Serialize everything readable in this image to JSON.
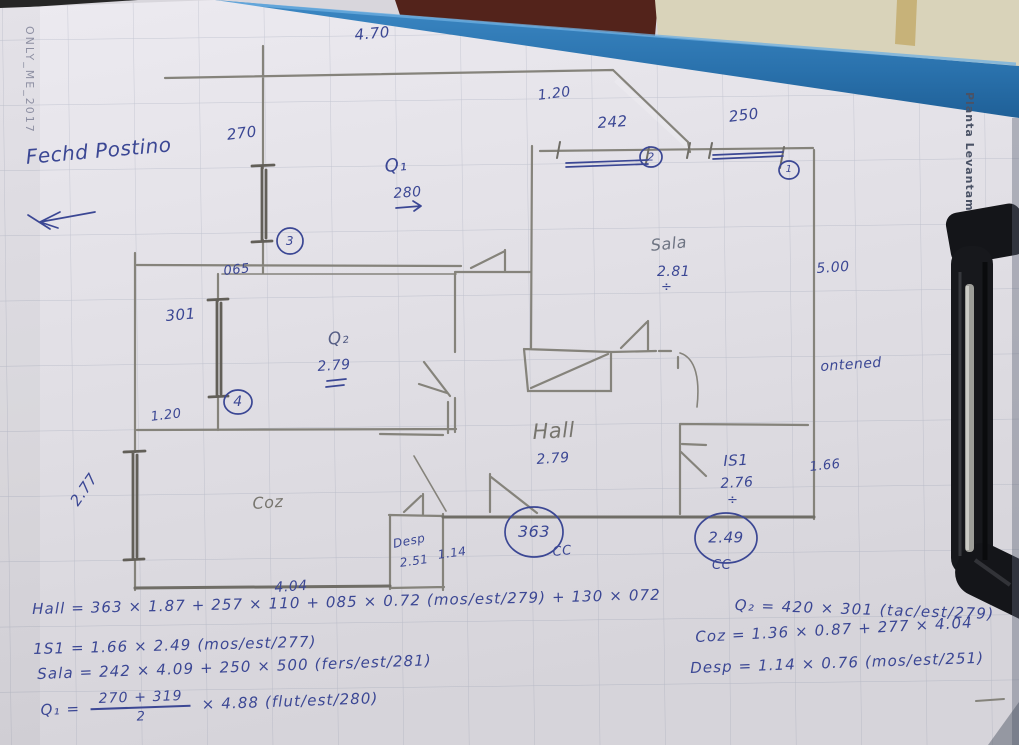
{
  "photo": {
    "margin_left_vertical_text": "ONLY_ME_2017",
    "margin_right_vertical_text": "Planta Levantamento"
  },
  "labels": {
    "note": "Fechd Postino",
    "d470": "4.70",
    "d270": "270",
    "ref1": "1",
    "ref2": "2",
    "ref3": "3",
    "ref4": "4",
    "d065": "065",
    "d301": "301",
    "d120_left": "1.20",
    "d277": "2.77",
    "coz": "Coz",
    "d404": "4.04",
    "desp": "Desp",
    "desp_h": "2.51",
    "d114": "1.14",
    "q1": "Q₁",
    "q1_h": "280",
    "d120_top": "1.20",
    "d242": "242",
    "d250": "250",
    "sala": "Sala",
    "sala_h": "2.81",
    "d500": "5.00",
    "ontened": "ontened",
    "q2": "Q₂",
    "q2_h": "2.79",
    "hall": "Hall",
    "hall_h": "2.79",
    "c363": "363",
    "cc_a": "CC",
    "is1": "IS1",
    "is1_h": "2.76",
    "div_sign": "÷",
    "d166": "1.66",
    "c249": "2.49",
    "cc_b": "CC"
  },
  "formulas": {
    "hall": "Hall = 363 × 1.87 + 257 × 110 + 085 × 0.72 (mos/est/279) + 130 × 072",
    "is1": "1S1 = 1.66 × 2.49 (mos/est/277)",
    "sala": "Sala = 242 × 4.09 + 250 × 500 (fers/est/281)",
    "q1_lhs": "Q₁ =",
    "q1_num": "270 + 319",
    "q1_den": "2",
    "q1_rhs": "× 4.88 (flut/est/280)",
    "q2": "Q₂ = 420 × 301 (tac/est/279)",
    "coz": "Coz = 1.36 × 0.87 + 277 × 4.04",
    "desp": "Desp = 1.14 × 0.76 (mos/est/251)"
  },
  "colors": {
    "ink_blue": "#3b4794",
    "pencil_gray": "#85837b",
    "clipboard_blue": "#2f79b4"
  }
}
